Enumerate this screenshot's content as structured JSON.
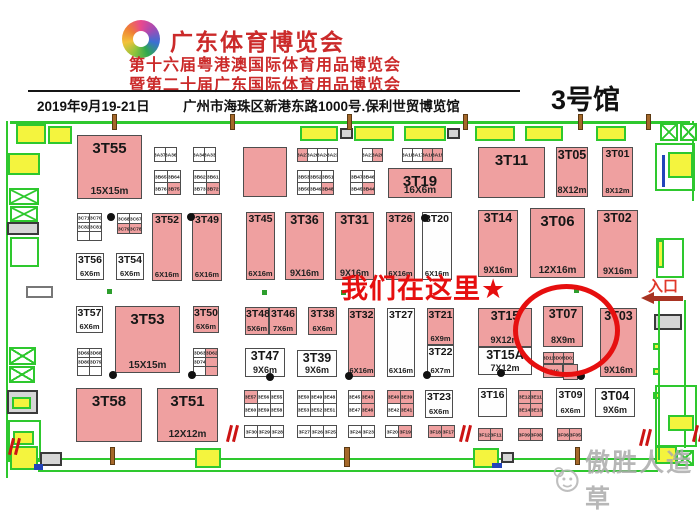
{
  "header": {
    "title": "广东体育博览会",
    "subtitle1": "第十六届粤港澳国际体育用品博览会",
    "subtitle2": "暨第二十届广东国际体育用品博览会",
    "date": "2019年9月19-21日",
    "address": "广州市海珠区新港东路1000号.保利世贸博览馆",
    "hall": "3号馆"
  },
  "annotations": {
    "here_text": "我们在这里★",
    "entrance_label": "入口",
    "watermark_text": "傲胜人造草",
    "highlighted_booth": "3T07"
  },
  "colors": {
    "booth_pink": "#efa0a0",
    "wall_green": "#2ec82e",
    "door_yellow": "#f4f43e",
    "highlight_red": "#e60f0f",
    "header_red": "#cb2a2a",
    "arrow_red": "#a83322",
    "watermark_gray": "#ababab"
  },
  "floorplan": {
    "booths": [
      {
        "id": "3T55",
        "x": 77,
        "y": 135,
        "w": 65,
        "h": 64,
        "pink": 1,
        "size": "15X15m"
      },
      {
        "id": "",
        "x": 243,
        "y": 147,
        "w": 44,
        "h": 50,
        "pink": 1,
        "size": ""
      },
      {
        "id": "3T11",
        "x": 478,
        "y": 147,
        "w": 67,
        "h": 51,
        "pink": 1,
        "size": ""
      },
      {
        "id": "3T05",
        "x": 556,
        "y": 147,
        "w": 32,
        "h": 50,
        "pink": 1,
        "size": "8X12m"
      },
      {
        "id": "3T01",
        "x": 602,
        "y": 147,
        "w": 31,
        "h": 50,
        "pink": 1,
        "size": "8X12m"
      },
      {
        "id": "3T19",
        "x": 388,
        "y": 168,
        "w": 64,
        "h": 30,
        "pink": 1,
        "size": "16X6m"
      },
      {
        "id": "3T52",
        "x": 152,
        "y": 213,
        "w": 30,
        "h": 68,
        "pink": 1,
        "size": "6X16m"
      },
      {
        "id": "3T49",
        "x": 192,
        "y": 213,
        "w": 30,
        "h": 68,
        "pink": 1,
        "size": "6X16m"
      },
      {
        "id": "3T45",
        "x": 246,
        "y": 212,
        "w": 29,
        "h": 68,
        "pink": 1,
        "size": "6X16m"
      },
      {
        "id": "3T36",
        "x": 285,
        "y": 212,
        "w": 39,
        "h": 68,
        "pink": 1,
        "size": "9X16m"
      },
      {
        "id": "3T31",
        "x": 335,
        "y": 212,
        "w": 39,
        "h": 68,
        "pink": 1,
        "size": "9X16m"
      },
      {
        "id": "3T26",
        "x": 386,
        "y": 212,
        "w": 29,
        "h": 68,
        "pink": 1,
        "size": "6X16m"
      },
      {
        "id": "3T20",
        "x": 422,
        "y": 212,
        "w": 30,
        "h": 68,
        "pink": 0,
        "size": "6X16m"
      },
      {
        "id": "3T14",
        "x": 478,
        "y": 210,
        "w": 40,
        "h": 67,
        "pink": 1,
        "size": "9X16m"
      },
      {
        "id": "3T06",
        "x": 530,
        "y": 208,
        "w": 55,
        "h": 70,
        "pink": 1,
        "size": "12X16m"
      },
      {
        "id": "3T02",
        "x": 597,
        "y": 210,
        "w": 41,
        "h": 68,
        "pink": 1,
        "size": "9X16m"
      },
      {
        "id": "3T56",
        "x": 76,
        "y": 253,
        "w": 28,
        "h": 27,
        "pink": 0,
        "size": "6X6m"
      },
      {
        "id": "3T54",
        "x": 116,
        "y": 253,
        "w": 28,
        "h": 27,
        "pink": 0,
        "size": "6X6m"
      },
      {
        "id": "3T57",
        "x": 76,
        "y": 306,
        "w": 27,
        "h": 27,
        "pink": 0,
        "size": "6X6m"
      },
      {
        "id": "3T53",
        "x": 115,
        "y": 306,
        "w": 65,
        "h": 67,
        "pink": 1,
        "size": "15X15m"
      },
      {
        "id": "3T50",
        "x": 193,
        "y": 306,
        "w": 26,
        "h": 27,
        "pink": 1,
        "size": "6X6m"
      },
      {
        "id": "3T48",
        "x": 245,
        "y": 307,
        "w": 24,
        "h": 28,
        "pink": 1,
        "size": "5X6m"
      },
      {
        "id": "3T46",
        "x": 269,
        "y": 307,
        "w": 28,
        "h": 28,
        "pink": 1,
        "size": "7X6m"
      },
      {
        "id": "3T38",
        "x": 308,
        "y": 307,
        "w": 29,
        "h": 28,
        "pink": 1,
        "size": "6X6m"
      },
      {
        "id": "3T32",
        "x": 348,
        "y": 308,
        "w": 27,
        "h": 69,
        "pink": 1,
        "size": "6X16m"
      },
      {
        "id": "3T27",
        "x": 387,
        "y": 308,
        "w": 28,
        "h": 69,
        "pink": 0,
        "size": "6X16m"
      },
      {
        "id": "3T21",
        "x": 427,
        "y": 308,
        "w": 27,
        "h": 37,
        "pink": 1,
        "size": "6X9m"
      },
      {
        "id": "3T22",
        "x": 427,
        "y": 345,
        "w": 27,
        "h": 32,
        "pink": 0,
        "size": "6X7m"
      },
      {
        "id": "3T15",
        "x": 478,
        "y": 308,
        "w": 54,
        "h": 39,
        "pink": 1,
        "size": "9X12m"
      },
      {
        "id": "3T15A",
        "x": 478,
        "y": 347,
        "w": 54,
        "h": 28,
        "pink": 0,
        "size": "7X12m"
      },
      {
        "id": "3T07",
        "x": 543,
        "y": 306,
        "w": 40,
        "h": 41,
        "pink": 1,
        "size": "8X9m"
      },
      {
        "id": "3T03",
        "x": 600,
        "y": 308,
        "w": 37,
        "h": 69,
        "pink": 1,
        "size": "9X16m"
      },
      {
        "id": "3T47",
        "x": 245,
        "y": 348,
        "w": 40,
        "h": 29,
        "pink": 0,
        "size": "9X6m"
      },
      {
        "id": "3T39",
        "x": 297,
        "y": 350,
        "w": 40,
        "h": 27,
        "pink": 0,
        "size": "9X6m"
      },
      {
        "id": "3T58",
        "x": 76,
        "y": 388,
        "w": 66,
        "h": 54,
        "pink": 1,
        "size": ""
      },
      {
        "id": "3T51",
        "x": 157,
        "y": 388,
        "w": 61,
        "h": 54,
        "pink": 1,
        "size": "12X12m"
      },
      {
        "id": "3T23",
        "x": 425,
        "y": 390,
        "w": 28,
        "h": 28,
        "pink": 0,
        "size": "6X6m"
      },
      {
        "id": "3T16",
        "x": 478,
        "y": 388,
        "w": 29,
        "h": 29,
        "pink": 0,
        "size": ""
      },
      {
        "id": "3T09",
        "x": 556,
        "y": 388,
        "w": 29,
        "h": 29,
        "pink": 0,
        "size": "6X6m"
      },
      {
        "id": "3T04",
        "x": 595,
        "y": 388,
        "w": 40,
        "h": 29,
        "pink": 0,
        "size": "9X6m"
      },
      {
        "id": "",
        "x": 563,
        "y": 364,
        "w": 15,
        "h": 16,
        "pink": 1,
        "size": ""
      }
    ],
    "cell_groups": [
      {
        "x": 154,
        "y": 147,
        "cw": 12,
        "ch": 15,
        "rows": [
          [
            [
              "3A37",
              0
            ],
            [
              "3A36",
              0
            ]
          ]
        ]
      },
      {
        "x": 193,
        "y": 147,
        "cw": 12,
        "ch": 15,
        "rows": [
          [
            [
              "3A34",
              0
            ],
            [
              "3A33",
              0
            ]
          ]
        ]
      },
      {
        "x": 154,
        "y": 170,
        "cw": 14,
        "ch": 13,
        "rows": [
          [
            [
              "3B65",
              0
            ],
            [
              "3B64",
              0
            ]
          ],
          [
            [
              "3B76",
              0
            ],
            [
              "3B75",
              1
            ]
          ]
        ]
      },
      {
        "x": 193,
        "y": 170,
        "cw": 14,
        "ch": 13,
        "rows": [
          [
            [
              "3B62",
              0
            ],
            [
              "3B61",
              0
            ]
          ],
          [
            [
              "3B73",
              0
            ],
            [
              "3B72",
              1
            ]
          ]
        ]
      },
      {
        "x": 297,
        "y": 148,
        "cw": 11,
        "ch": 14,
        "rows": [
          [
            [
              "3A27",
              1
            ],
            [
              "3A26",
              0
            ],
            [
              "3A24",
              0
            ],
            [
              "3A23",
              0
            ]
          ]
        ]
      },
      {
        "x": 362,
        "y": 148,
        "cw": 11,
        "ch": 14,
        "rows": [
          [
            [
              "3A21",
              0
            ],
            [
              "3A20",
              1
            ]
          ]
        ]
      },
      {
        "x": 402,
        "y": 148,
        "cw": 11,
        "ch": 14,
        "rows": [
          [
            [
              "3A18",
              0
            ],
            [
              "3A17",
              0
            ],
            [
              "3A16",
              1
            ],
            [
              "3A15",
              1
            ]
          ]
        ]
      },
      {
        "x": 297,
        "y": 170,
        "cw": 13,
        "ch": 13,
        "rows": [
          [
            [
              "3B53",
              0
            ],
            [
              "3B52",
              0
            ],
            [
              "3B51",
              0
            ]
          ],
          [
            [
              "3B50",
              0
            ],
            [
              "3B49",
              0
            ],
            [
              "3B48",
              1
            ]
          ]
        ]
      },
      {
        "x": 350,
        "y": 170,
        "cw": 13,
        "ch": 13,
        "rows": [
          [
            [
              "3B47",
              0
            ],
            [
              "3B46",
              0
            ]
          ],
          [
            [
              "3B45",
              0
            ],
            [
              "3B44",
              1
            ]
          ]
        ]
      },
      {
        "x": 77,
        "y": 213,
        "cw": 13,
        "ch": 10,
        "rows": [
          [
            [
              "3C71",
              0
            ],
            [
              "3C70",
              0
            ]
          ],
          [
            [
              "3C82",
              0
            ],
            [
              "3C81",
              0
            ]
          ],
          [
            [
              "",
              0
            ],
            [
              "",
              0
            ]
          ]
        ]
      },
      {
        "x": 117,
        "y": 213,
        "cw": 13,
        "ch": 11,
        "rows": [
          [
            [
              "3C68",
              0
            ],
            [
              "3C67",
              0
            ]
          ],
          [
            [
              "3C79",
              1
            ],
            [
              "3C78",
              1
            ]
          ]
        ]
      },
      {
        "x": 77,
        "y": 348,
        "cw": 13,
        "ch": 10,
        "rows": [
          [
            [
              "3D69",
              0
            ],
            [
              "3D68",
              0
            ]
          ],
          [
            [
              "3D80",
              0
            ],
            [
              "3D79",
              0
            ]
          ],
          [
            [
              "",
              0
            ],
            [
              "",
              0
            ]
          ]
        ]
      },
      {
        "x": 193,
        "y": 348,
        "cw": 13,
        "ch": 10,
        "rows": [
          [
            [
              "3D63",
              0
            ],
            [
              "3D62",
              1
            ]
          ],
          [
            [
              "3D74",
              0
            ],
            [
              "",
              1
            ]
          ],
          [
            [
              "",
              0
            ],
            [
              "",
              1
            ]
          ]
        ]
      },
      {
        "x": 244,
        "y": 390,
        "cw": 14,
        "ch": 14,
        "rows": [
          [
            [
              "3E57",
              1
            ],
            [
              "3E56",
              0
            ],
            [
              "3E55",
              0
            ]
          ],
          [
            [
              "3E60",
              0
            ],
            [
              "3E59",
              0
            ],
            [
              "3E58",
              0
            ]
          ]
        ]
      },
      {
        "x": 297,
        "y": 390,
        "cw": 14,
        "ch": 14,
        "rows": [
          [
            [
              "3E50",
              0
            ],
            [
              "3E49",
              0
            ],
            [
              "3E48",
              0
            ]
          ],
          [
            [
              "3E53",
              0
            ],
            [
              "3E52",
              0
            ],
            [
              "3E51",
              0
            ]
          ]
        ]
      },
      {
        "x": 348,
        "y": 390,
        "cw": 14,
        "ch": 14,
        "rows": [
          [
            [
              "3E45",
              0
            ],
            [
              "3E43",
              1
            ]
          ],
          [
            [
              "3E47",
              0
            ],
            [
              "3E46",
              1
            ]
          ]
        ]
      },
      {
        "x": 387,
        "y": 390,
        "cw": 14,
        "ch": 14,
        "rows": [
          [
            [
              "3E40",
              1
            ],
            [
              "3E39",
              1
            ]
          ],
          [
            [
              "3E42",
              0
            ],
            [
              "3E41",
              1
            ]
          ]
        ]
      },
      {
        "x": 518,
        "y": 390,
        "cw": 13,
        "ch": 14,
        "rows": [
          [
            [
              "3E12",
              1
            ],
            [
              "3E11",
              1
            ]
          ],
          [
            [
              "3E14",
              1
            ],
            [
              "3E13",
              1
            ]
          ]
        ]
      },
      {
        "x": 543,
        "y": 352,
        "cw": 11,
        "ch": 12,
        "rows": [
          [
            [
              "3D11",
              1
            ],
            [
              "3D05",
              1
            ],
            [
              "3D01",
              1
            ]
          ]
        ]
      },
      {
        "x": 543,
        "y": 364,
        "cw": 20,
        "ch": 14,
        "rows": [
          [
            [
              "3D10",
              1
            ]
          ]
        ]
      },
      {
        "x": 244,
        "y": 425,
        "cw": 14,
        "ch": 13,
        "rows": [
          [
            [
              "3F30",
              0
            ],
            [
              "3F29",
              0
            ],
            [
              "3F28",
              0
            ]
          ]
        ]
      },
      {
        "x": 297,
        "y": 425,
        "cw": 14,
        "ch": 13,
        "rows": [
          [
            [
              "3F27",
              0
            ],
            [
              "3F26",
              0
            ],
            [
              "3F25",
              0
            ]
          ]
        ]
      },
      {
        "x": 348,
        "y": 425,
        "cw": 14,
        "ch": 13,
        "rows": [
          [
            [
              "3F24",
              0
            ],
            [
              "3F23",
              0
            ]
          ]
        ]
      },
      {
        "x": 385,
        "y": 425,
        "cw": 14,
        "ch": 13,
        "rows": [
          [
            [
              "3F20",
              0
            ],
            [
              "3F19",
              1
            ]
          ]
        ]
      },
      {
        "x": 428,
        "y": 425,
        "cw": 14,
        "ch": 13,
        "rows": [
          [
            [
              "3F18",
              1
            ],
            [
              "3F17",
              1
            ]
          ]
        ]
      },
      {
        "x": 478,
        "y": 428,
        "cw": 13,
        "ch": 13,
        "rows": [
          [
            [
              "3F12",
              1
            ],
            [
              "3F11",
              1
            ]
          ]
        ]
      },
      {
        "x": 518,
        "y": 428,
        "cw": 13,
        "ch": 13,
        "rows": [
          [
            [
              "3F09",
              1
            ],
            [
              "3F08",
              1
            ]
          ]
        ]
      },
      {
        "x": 557,
        "y": 428,
        "cw": 13,
        "ch": 13,
        "rows": [
          [
            [
              "3F06",
              1
            ],
            [
              "3F05",
              1
            ]
          ]
        ]
      }
    ],
    "dots": [
      [
        107,
        213
      ],
      [
        187,
        213
      ],
      [
        421,
        214
      ],
      [
        109,
        371
      ],
      [
        188,
        371
      ],
      [
        266,
        373
      ],
      [
        345,
        372
      ],
      [
        423,
        371
      ],
      [
        497,
        369
      ],
      [
        577,
        372
      ]
    ],
    "green_squares": [
      [
        107,
        289
      ],
      [
        262,
        290
      ],
      [
        341,
        290
      ],
      [
        574,
        288
      ]
    ]
  }
}
